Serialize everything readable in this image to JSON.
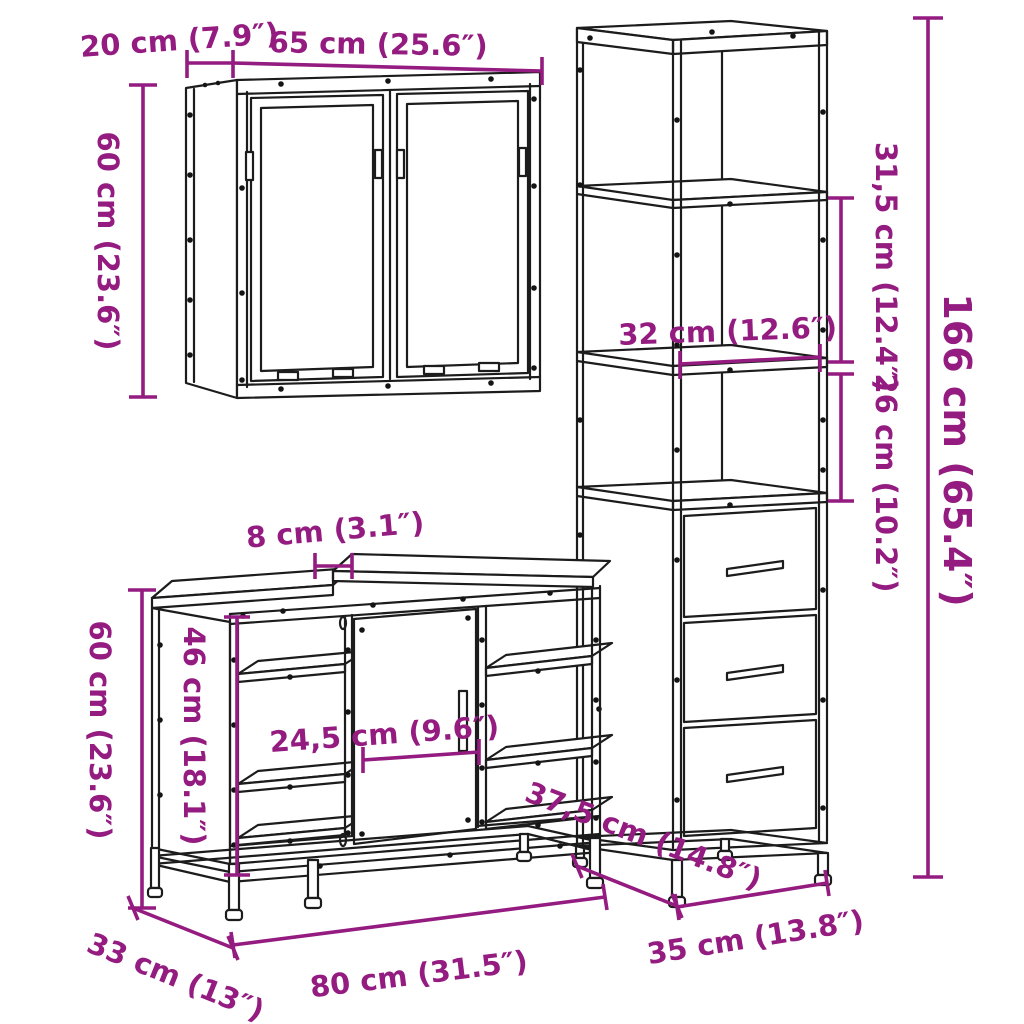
{
  "figure": {
    "type": "product dimension line-drawing",
    "subject": "3-piece bathroom furniture set (wall mirror cabinet, sink vanity cabinet, tall storage cabinet)"
  },
  "colors": {
    "dimension_annotation": "#941b80",
    "furniture_line": "#1c1c1c",
    "background": "#ffffff"
  },
  "dims": {
    "wall_depth": "20 cm (7.9″)",
    "wall_width": "65 cm (25.6″)",
    "wall_height": "60 cm (23.6″)",
    "tall_top_section_height": "31,5 cm (12.4″)",
    "tall_open_section_height": "26 cm (10.2″)",
    "tall_total_height": "166 cm (65.4″)",
    "tall_inner_width": "32 cm (12.6″)",
    "tall_depth": "37,5 cm (14.8″)",
    "tall_width": "35 cm (13.8″)",
    "vanity_gap": "8 cm (3.1″)",
    "vanity_height": "60 cm (23.6″)",
    "vanity_inner_height": "46 cm (18.1″)",
    "vanity_door_width": "24,5 cm (9.6″)",
    "vanity_depth": "33 cm (13″)",
    "vanity_width": "80 cm (31.5″)"
  }
}
